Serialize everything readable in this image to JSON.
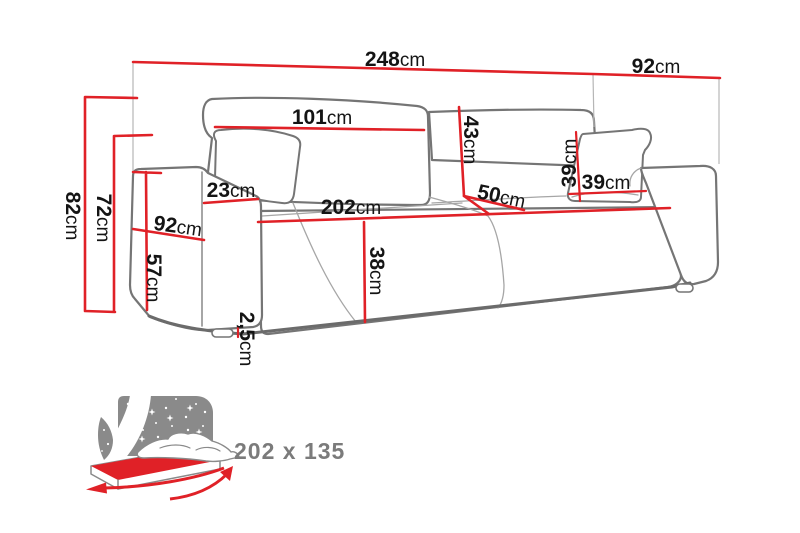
{
  "title": "Sofa dimension diagram",
  "colors": {
    "dimension_line": "#e02127",
    "sketch_outline": "#757575",
    "icon_gray": "#8a8a8a",
    "label_text": "#141414",
    "size_text": "#7b7b7b"
  },
  "dims": {
    "width_total": {
      "value": "248",
      "unit": "cm"
    },
    "depth_total": {
      "value": "92",
      "unit": "cm"
    },
    "back_cushion_width": {
      "value": "101",
      "unit": "cm"
    },
    "backrest_height": {
      "value": "43",
      "unit": "cm"
    },
    "armrest_width": {
      "value": "23",
      "unit": "cm"
    },
    "side_depth": {
      "value": "92",
      "unit": "cm"
    },
    "height_total": {
      "value": "82",
      "unit": "cm"
    },
    "back_height": {
      "value": "72",
      "unit": "cm"
    },
    "seat_floor_height": {
      "value": "57",
      "unit": "cm"
    },
    "seat_width": {
      "value": "202",
      "unit": "cm"
    },
    "seat_depth": {
      "value": "50",
      "unit": "cm"
    },
    "front_height": {
      "value": "38",
      "unit": "cm"
    },
    "pillow_height": {
      "value": "39",
      "unit": "cm"
    },
    "pillow_width": {
      "value": "39",
      "unit": "cm"
    },
    "base_gap": {
      "value": "2,5",
      "unit": "cm"
    }
  },
  "sleeping": {
    "size": "202 x 135"
  }
}
